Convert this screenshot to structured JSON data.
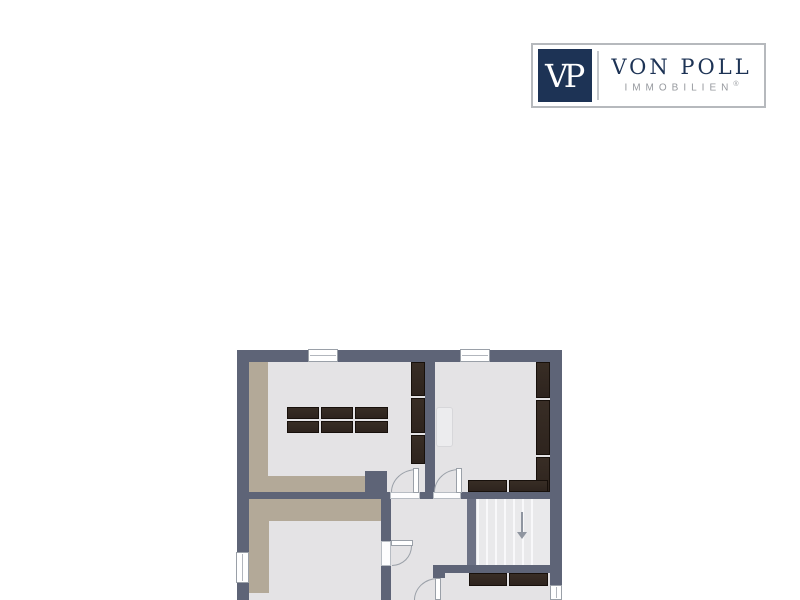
{
  "page": {
    "background": "#ffffff"
  },
  "logo": {
    "monogram": "VP",
    "brand": "VON POLL",
    "subtitle": "IMMOBILIEN",
    "registered_mark": "®",
    "colors": {
      "navy": "#1d3355",
      "subtitle_gray": "#96999e",
      "border_gray": "#b6b9bd"
    }
  },
  "floorplan": {
    "colors": {
      "wall": "#5e6477",
      "wall_light": "#6d7285",
      "floor": "#e4e3e5",
      "accent_floor": "#b3a998",
      "stairs": "#e9e9eb",
      "stair_tread": "#f8f8fa",
      "furniture": "#2e241e",
      "furniture_edge": "#17100b",
      "door_line": "#9aa0a8",
      "window_frame": "#9aa0a8"
    },
    "zones": [
      {
        "id": "room-upper-left"
      },
      {
        "id": "room-upper-right"
      },
      {
        "id": "room-lower-left"
      },
      {
        "id": "room-lower-right"
      },
      {
        "id": "hallway"
      },
      {
        "id": "staircase"
      }
    ],
    "counts": {
      "windows_visible": 4,
      "doors_visible": 4,
      "stair_treads_visible": 7
    }
  }
}
